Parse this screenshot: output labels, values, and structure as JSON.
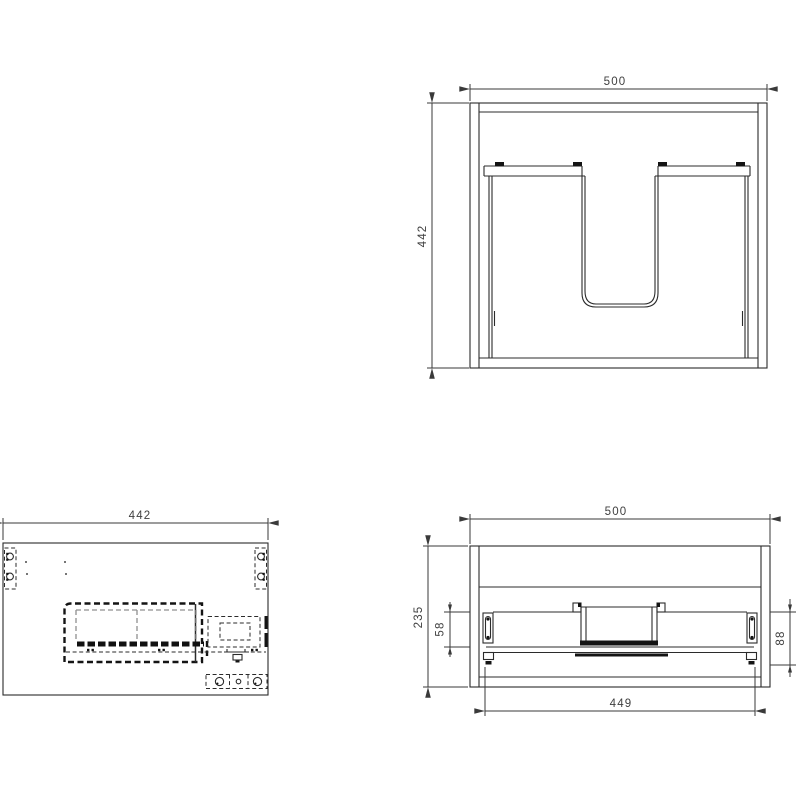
{
  "drawing": {
    "background": "#ffffff",
    "line_color": "#2b2b2b",
    "hidden_line_color": "#8f8f8f",
    "views": {
      "back_view": {
        "width_mm": "500",
        "height_mm": "442"
      },
      "side_view": {
        "depth_mm": "442"
      },
      "front_view": {
        "width_mm": "500",
        "height_mm": "235",
        "slide_top_offset_mm": "58",
        "slide_bottom_offset_mm": "88",
        "inner_width_mm": "449"
      }
    }
  }
}
